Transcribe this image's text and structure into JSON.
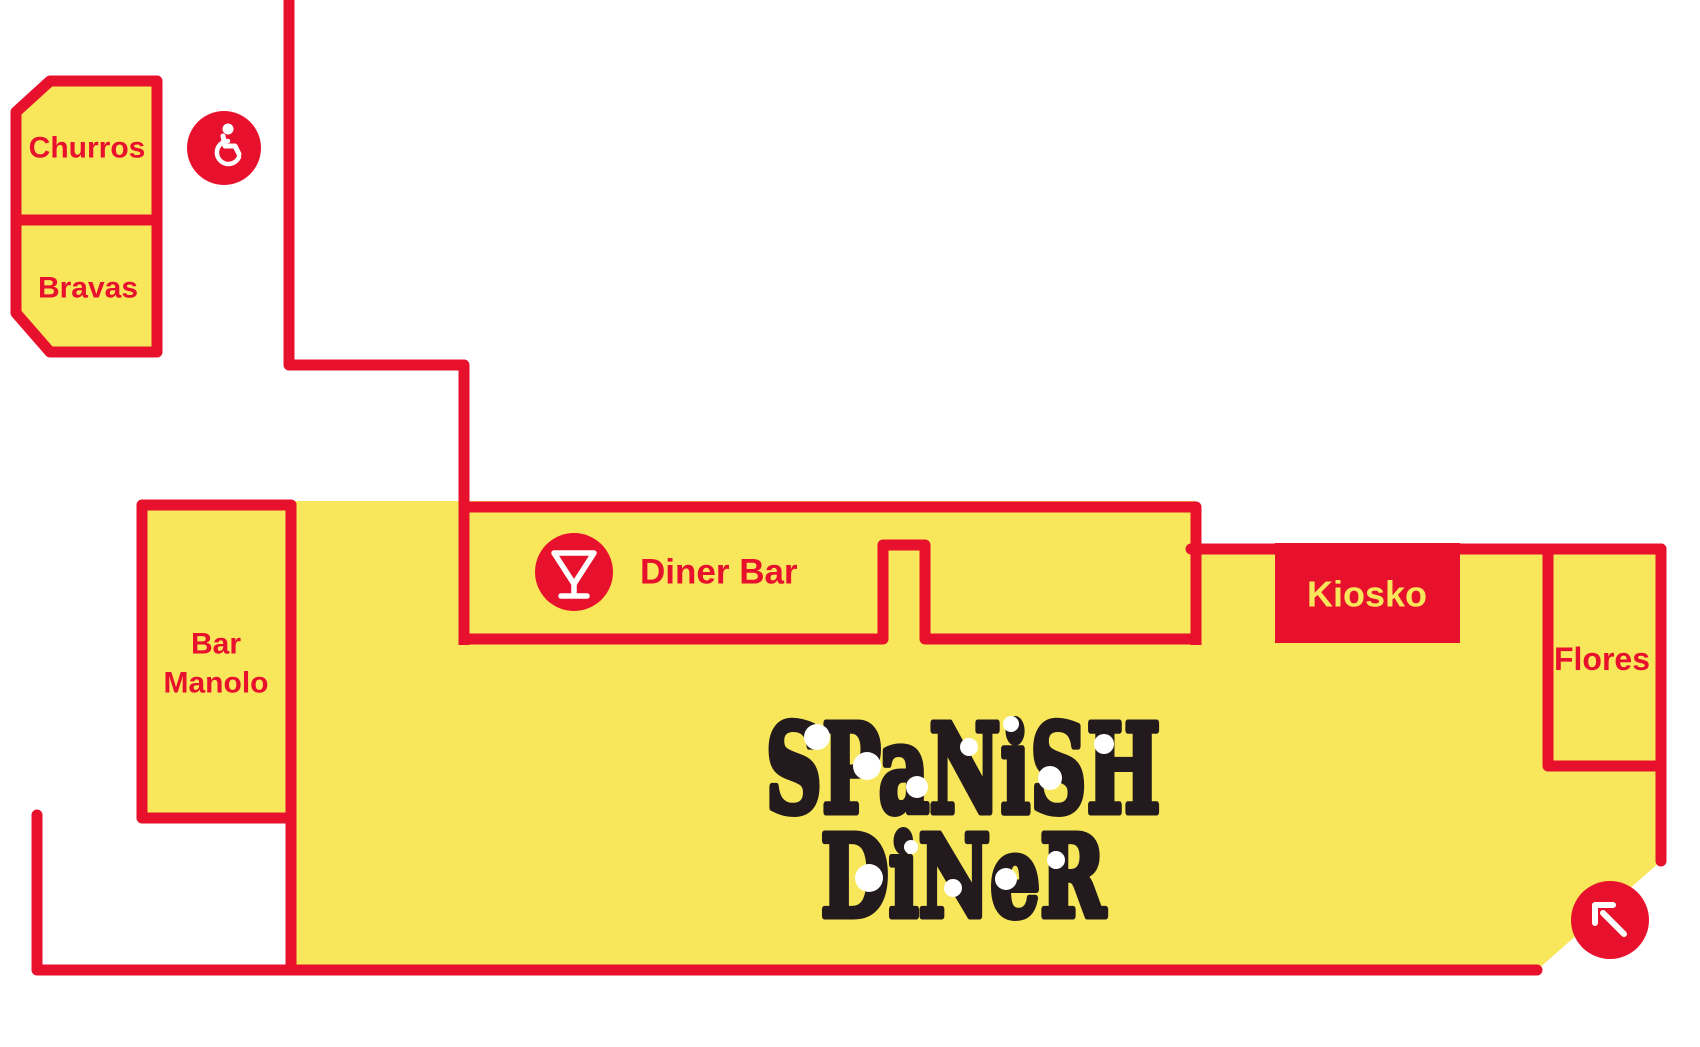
{
  "colors": {
    "red": "#e8112d",
    "yellow": "#f8e75a",
    "black": "#221a1d",
    "white": "#ffffff"
  },
  "map": {
    "rooms": {
      "churros": {
        "label": "Churros"
      },
      "bravas": {
        "label": "Bravas"
      },
      "bar_manolo": {
        "label_line1": "Bar",
        "label_line2": "Manolo"
      },
      "diner_bar": {
        "label": "Diner Bar"
      },
      "kiosko": {
        "label": "Kiosko"
      },
      "flores": {
        "label": "Flores"
      }
    },
    "logo": {
      "line1": "SPaNiSH",
      "line2": "DiNeR"
    },
    "icons": {
      "accessibility": "wheelchair-accessible-icon",
      "cocktail": "cocktail-bar-icon",
      "exit_arrow": "arrow-up-left-icon"
    }
  }
}
